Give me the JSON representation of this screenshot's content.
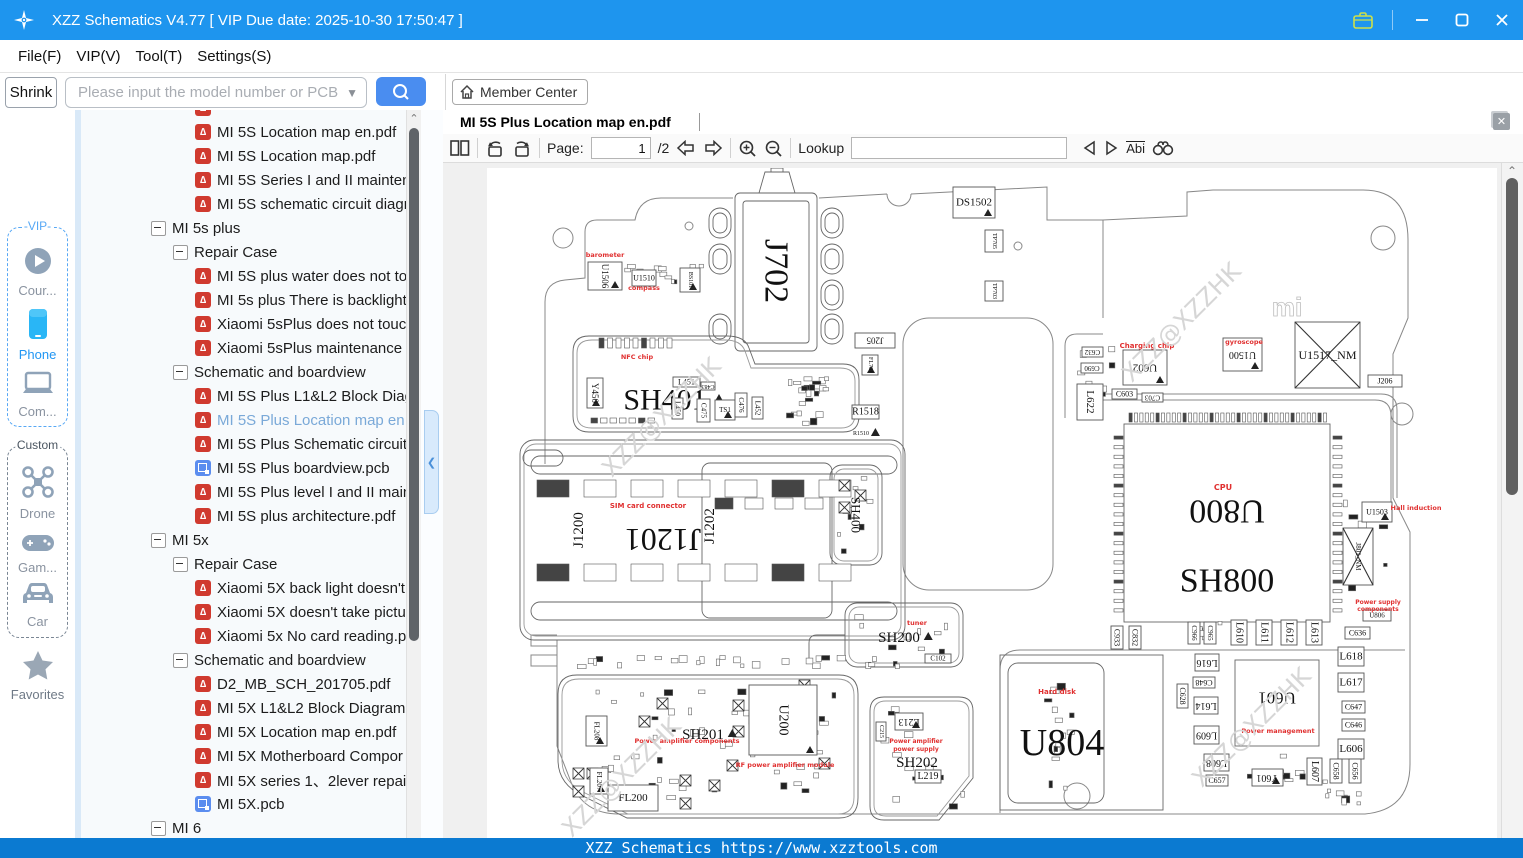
{
  "window": {
    "title": "XZZ Schematics V4.77 [ VIP Due date: 2025-10-30 17:50:47 ]",
    "menu": [
      "File(F)",
      "VIP(V)",
      "Tool(T)",
      "Settings(S)"
    ]
  },
  "toolbar": {
    "shrink": "Shrink",
    "search_placeholder": "Please input the model number or PCB",
    "member_center": "Member Center"
  },
  "sidebar": {
    "vip_label": "-VIP-",
    "custom_label": "Custom",
    "vip_items": [
      {
        "id": "course",
        "label": "Cour..."
      },
      {
        "id": "phone",
        "label": "Phone"
      },
      {
        "id": "computer",
        "label": "Com..."
      }
    ],
    "custom_items": [
      {
        "id": "drone",
        "label": "Drone"
      },
      {
        "id": "game",
        "label": "Gam..."
      },
      {
        "id": "car",
        "label": "Car"
      }
    ],
    "favorites_label": "Favorites"
  },
  "tree": {
    "items": [
      {
        "type": "pdf",
        "label": ""
      },
      {
        "type": "pdf",
        "label": "MI 5S Location map en.pdf"
      },
      {
        "type": "pdf",
        "label": "MI 5S Location map.pdf"
      },
      {
        "type": "pdf",
        "label": "MI 5S Series I and II mainten"
      },
      {
        "type": "pdf",
        "label": "MI 5S schematic circuit diagr"
      },
      {
        "type": "node",
        "depth": 0,
        "label": "MI 5s plus"
      },
      {
        "type": "node",
        "depth": 1,
        "label": "Repair Case"
      },
      {
        "type": "pdf",
        "label": "MI 5S plus water does not to"
      },
      {
        "type": "pdf",
        "label": "MI 5s plus There is backlight"
      },
      {
        "type": "pdf",
        "label": "Xiaomi 5sPlus does not touc"
      },
      {
        "type": "pdf",
        "label": "Xiaomi 5sPlus maintenance v"
      },
      {
        "type": "node",
        "depth": 1,
        "label": "Schematic and boardview"
      },
      {
        "type": "pdf",
        "label": "MI 5S Plus L1&L2 Block Diag"
      },
      {
        "type": "pdf",
        "label": "MI 5S Plus Location map en.",
        "selected": true
      },
      {
        "type": "pdf",
        "label": "MI 5S Plus Schematic circuit"
      },
      {
        "type": "pcb",
        "label": "MI 5S Plus boardview.pcb"
      },
      {
        "type": "pdf",
        "label": "MI 5S Plus level I and II main"
      },
      {
        "type": "pdf",
        "label": "MI 5S plus architecture.pdf"
      },
      {
        "type": "node",
        "depth": 0,
        "label": "MI 5x"
      },
      {
        "type": "node",
        "depth": 1,
        "label": "Repair Case"
      },
      {
        "type": "pdf",
        "label": "Xiaomi 5X back light doesn't"
      },
      {
        "type": "pdf",
        "label": "Xiaomi 5X doesn't take pictu"
      },
      {
        "type": "pdf",
        "label": "Xiaomi 5x No card reading.p"
      },
      {
        "type": "node",
        "depth": 1,
        "label": "Schematic and boardview"
      },
      {
        "type": "pdf",
        "label": "D2_MB_SCH_201705.pdf"
      },
      {
        "type": "pdf",
        "label": "MI 5X L1&L2 Block Diagram"
      },
      {
        "type": "pdf",
        "label": "MI 5X Location map en.pdf"
      },
      {
        "type": "pdf",
        "label": "MI 5X Motherboard Compor"
      },
      {
        "type": "pdf",
        "label": "MI 5X series 1、2lever repair"
      },
      {
        "type": "pcb",
        "label": "MI 5X.pcb"
      },
      {
        "type": "node",
        "depth": 0,
        "label": "MI 6"
      }
    ]
  },
  "viewer": {
    "tab": "MI 5S Plus Location map en.pdf",
    "page_label": "Page:",
    "page_value": "1",
    "page_total": "/2",
    "lookup_label": "Lookup",
    "abi_label": "Abi"
  },
  "statusbar": {
    "text": "XZZ Schematics https://www.xzztools.com"
  },
  "colors": {
    "titlebar": "#1e95ee",
    "accent_blue": "#4a8df0",
    "status_blue": "#0b7ad1",
    "pdf_red": "#d03a2f",
    "pcb_blue": "#5b8def",
    "selected_text": "#7aa9d8",
    "schem_red": "#e03030"
  },
  "schematic": {
    "watermark_text": "XZZ@XZZHK",
    "watermarks": [
      [
        180,
        255
      ],
      [
        700,
        160
      ],
      [
        770,
        565
      ],
      [
        140,
        615
      ]
    ],
    "mi_logo": "mi",
    "red_labels": [
      [
        "barometer",
        118,
        89,
        6.5
      ],
      [
        "compass",
        157,
        122,
        6.5
      ],
      [
        "NFC chip",
        150,
        191,
        6.5
      ],
      [
        "SIM card connector",
        161,
        340,
        7
      ],
      [
        "tuner",
        430,
        457,
        6.5
      ],
      [
        "Charging chip",
        660,
        180,
        7
      ],
      [
        "gyroscope",
        757,
        176,
        6.5
      ],
      [
        "CPU",
        736,
        322,
        8
      ],
      [
        "Hall induction",
        929,
        342,
        6.5
      ],
      [
        "Power supply",
        891,
        436,
        6
      ],
      [
        "components",
        891,
        443,
        6
      ],
      [
        "Hard disk",
        570,
        526,
        7
      ],
      [
        "Power management",
        791,
        565,
        6.5
      ],
      [
        "Power amplifier components",
        200,
        575,
        6.5
      ],
      [
        "RF power amplifier module",
        298,
        599,
        6.5
      ],
      [
        "Power amplifier",
        429,
        575,
        6
      ],
      [
        "power supply",
        429,
        583,
        6
      ]
    ],
    "components": [
      [
        "box",
        "DS1502",
        466,
        19,
        42,
        31,
        0,
        11,
        1
      ],
      [
        "lbl",
        "J702",
        289,
        103,
        0,
        0,
        90,
        34,
        0
      ],
      [
        "box",
        "TP705",
        498,
        62,
        18,
        22,
        90,
        6,
        0
      ],
      [
        "box",
        "TP703",
        498,
        113,
        18,
        20,
        90,
        6,
        0
      ],
      [
        "box",
        "U1506",
        101,
        94,
        34,
        28,
        90,
        9,
        1
      ],
      [
        "box",
        "U1510",
        145,
        102,
        24,
        16,
        0,
        8,
        0
      ],
      [
        "box",
        "BS101",
        193,
        100,
        20,
        24,
        90,
        6,
        1
      ],
      [
        "lbl",
        "SH401",
        178,
        232,
        0,
        0,
        0,
        30,
        1
      ],
      [
        "box",
        "Y450",
        100,
        210,
        16,
        30,
        90,
        9,
        1
      ],
      [
        "box",
        "L451",
        186,
        209,
        27,
        10,
        0,
        8,
        0
      ],
      [
        "box",
        "C483",
        214,
        214,
        14,
        8,
        180,
        6,
        0
      ],
      [
        "box",
        "L450",
        185,
        230,
        11,
        21,
        90,
        7,
        0
      ],
      [
        "box",
        "C475",
        210,
        231,
        13,
        23,
        90,
        7,
        0
      ],
      [
        "box",
        "TS1",
        228,
        232,
        20,
        20,
        0,
        7,
        1
      ],
      [
        "box",
        "C476",
        248,
        225,
        12,
        24,
        90,
        7,
        0
      ],
      [
        "box",
        "L452",
        265,
        229,
        11,
        22,
        90,
        7,
        0
      ],
      [
        "box",
        "J205",
        368,
        165,
        40,
        15,
        180,
        9,
        0
      ],
      [
        "box",
        "FL701",
        375,
        187,
        16,
        20,
        90,
        6,
        1
      ],
      [
        "box",
        "R1518",
        365,
        237,
        27,
        14,
        0,
        10,
        0
      ],
      [
        "lbl",
        "R1510",
        374,
        266,
        0,
        0,
        0,
        6,
        1
      ],
      [
        "lbl",
        "J1200",
        92,
        362,
        0,
        0,
        -90,
        15,
        0
      ],
      [
        "lbl",
        "J1201",
        176,
        372,
        0,
        0,
        180,
        32,
        0
      ],
      [
        "lbl",
        "J1202",
        223,
        358,
        0,
        0,
        -90,
        15,
        0
      ],
      [
        "lbl",
        "SH400",
        369,
        347,
        0,
        0,
        90,
        13,
        0
      ],
      [
        "lbl",
        "SH200",
        412,
        470,
        0,
        0,
        0,
        15,
        1
      ],
      [
        "box",
        "C102",
        438,
        486,
        26,
        9,
        0,
        7,
        0
      ],
      [
        "box",
        "L213",
        408,
        545,
        28,
        17,
        180,
        10,
        1
      ],
      [
        "lbl",
        "SH202",
        430,
        595,
        0,
        0,
        0,
        15,
        0
      ],
      [
        "box",
        "L219",
        428,
        602,
        26,
        13,
        0,
        10,
        0
      ],
      [
        "box",
        "C215",
        389,
        554,
        10,
        19,
        90,
        6,
        0
      ],
      [
        "lbl",
        "SH201",
        216,
        567,
        0,
        0,
        0,
        15,
        1
      ],
      [
        "box",
        "U200",
        262,
        517,
        68,
        70,
        90,
        14,
        1
      ],
      [
        "box",
        "FL200",
        121,
        617,
        50,
        26,
        0,
        11,
        0
      ],
      [
        "box",
        "FL208",
        99,
        548,
        21,
        30,
        90,
        7,
        1
      ],
      [
        "box",
        "FL207",
        103,
        600,
        18,
        26,
        90,
        7,
        1
      ],
      [
        "lbl",
        "U800",
        740,
        343,
        0,
        0,
        180,
        34,
        0
      ],
      [
        "lbl",
        "SH800",
        740,
        413,
        0,
        0,
        0,
        34,
        0
      ],
      [
        "xbox",
        "U1517_NM",
        808,
        154,
        65,
        66,
        0,
        12,
        0
      ],
      [
        "box",
        "U1500",
        736,
        170,
        39,
        33,
        180,
        10,
        1
      ],
      [
        "box",
        "U602",
        636,
        182,
        44,
        35,
        180,
        11,
        1
      ],
      [
        "box",
        "C632",
        595,
        179,
        21,
        10,
        180,
        7,
        0
      ],
      [
        "box",
        "C690",
        594,
        195,
        22,
        10,
        180,
        7,
        0
      ],
      [
        "box",
        "L622",
        590,
        216,
        26,
        36,
        90,
        11,
        0
      ],
      [
        "box",
        "C603",
        625,
        221,
        25,
        10,
        0,
        8,
        0
      ],
      [
        "box",
        "C703",
        655,
        225,
        21,
        9,
        180,
        7,
        0
      ],
      [
        "box",
        "J206",
        881,
        207,
        34,
        12,
        0,
        8,
        0
      ],
      [
        "box",
        "U1503",
        875,
        334,
        30,
        20,
        0,
        8,
        1
      ],
      [
        "xbox",
        "J801_NM",
        856,
        360,
        30,
        57,
        90,
        7,
        0
      ],
      [
        "box",
        "U806",
        876,
        442,
        28,
        11,
        0,
        7,
        0
      ],
      [
        "box",
        "L610",
        744,
        452,
        16,
        25,
        90,
        10,
        0
      ],
      [
        "box",
        "L611",
        769,
        452,
        16,
        25,
        90,
        10,
        0
      ],
      [
        "box",
        "L612",
        794,
        452,
        16,
        25,
        90,
        10,
        0
      ],
      [
        "box",
        "L613",
        819,
        452,
        16,
        25,
        90,
        10,
        0
      ],
      [
        "box",
        "C966",
        701,
        454,
        12,
        22,
        90,
        7,
        0
      ],
      [
        "box",
        "C965",
        717,
        454,
        12,
        22,
        90,
        7,
        0
      ],
      [
        "box",
        "C636",
        858,
        459,
        25,
        12,
        0,
        8,
        0
      ],
      [
        "box",
        "L618",
        851,
        479,
        26,
        19,
        0,
        11,
        0
      ],
      [
        "box",
        "L617",
        851,
        505,
        26,
        19,
        0,
        11,
        0
      ],
      [
        "box",
        "C647",
        855,
        533,
        23,
        12,
        0,
        8,
        0
      ],
      [
        "box",
        "C646",
        855,
        551,
        23,
        12,
        0,
        8,
        0
      ],
      [
        "box",
        "L606",
        851,
        571,
        26,
        20,
        0,
        11,
        0
      ],
      [
        "box",
        "L616",
        708,
        486,
        24,
        17,
        180,
        10,
        0
      ],
      [
        "box",
        "C648",
        706,
        509,
        22,
        11,
        180,
        8,
        0
      ],
      [
        "box",
        "C628",
        690,
        516,
        11,
        24,
        90,
        8,
        0
      ],
      [
        "box",
        "L614",
        707,
        529,
        24,
        17,
        180,
        10,
        0
      ],
      [
        "box",
        "L609",
        707,
        558,
        25,
        18,
        180,
        10,
        0
      ],
      [
        "box",
        "L608",
        717,
        586,
        25,
        17,
        180,
        10,
        0
      ],
      [
        "box",
        "C657",
        719,
        607,
        22,
        11,
        0,
        8,
        0
      ],
      [
        "box",
        "C933",
        624,
        458,
        12,
        23,
        90,
        8,
        0
      ],
      [
        "box",
        "C832",
        642,
        458,
        12,
        23,
        90,
        8,
        0
      ],
      [
        "lbl",
        "U601",
        790,
        530,
        0,
        0,
        180,
        17,
        0
      ],
      [
        "box",
        "Y601",
        765,
        601,
        31,
        17,
        180,
        10,
        1
      ],
      [
        "box",
        "L607",
        820,
        590,
        15,
        27,
        90,
        10,
        0
      ],
      [
        "box",
        "C658",
        843,
        591,
        12,
        24,
        90,
        8,
        0
      ],
      [
        "box",
        "C656",
        862,
        591,
        12,
        24,
        90,
        8,
        0
      ],
      [
        "lbl",
        "U804",
        575,
        575,
        0,
        0,
        0,
        38,
        0
      ]
    ],
    "clusters": [
      [
        292,
        206,
        50,
        52,
        24,
        7
      ],
      [
        137,
        96,
        50,
        30,
        8,
        11
      ],
      [
        590,
        176,
        42,
        70,
        10,
        13
      ],
      [
        78,
        487,
        335,
        16,
        26,
        17
      ],
      [
        100,
        518,
        250,
        115,
        48,
        19
      ],
      [
        392,
        534,
        86,
        108,
        12,
        23
      ],
      [
        742,
        585,
        105,
        32,
        10,
        29
      ],
      [
        350,
        306,
        40,
        82,
        8,
        31
      ],
      [
        366,
        442,
        104,
        52,
        10,
        37
      ],
      [
        556,
        494,
        34,
        136,
        14,
        41
      ],
      [
        856,
        332,
        46,
        92,
        10,
        43
      ],
      [
        698,
        452,
        40,
        24,
        6,
        47
      ],
      [
        183,
        96,
        36,
        28,
        6,
        53
      ],
      [
        836,
        618,
        60,
        20,
        8,
        59
      ]
    ],
    "pin_rows": [
      [
        642,
        245,
        37,
        5.4,
        0,
        3.2,
        9
      ],
      [
        627,
        268,
        19,
        0,
        9.6,
        9,
        3.2
      ],
      [
        846,
        268,
        19,
        0,
        9.6,
        9,
        3.2
      ],
      [
        112,
        170,
        9,
        8.5,
        0,
        5,
        10
      ],
      [
        104,
        250,
        7,
        9.5,
        0,
        6.5,
        5
      ],
      [
        50,
        312,
        7,
        47,
        0,
        32,
        17
      ],
      [
        50,
        396,
        7,
        47,
        0,
        32,
        17
      ],
      [
        228,
        330,
        4,
        30,
        0,
        18,
        11
      ]
    ],
    "crossed_small": [
      [
        86,
        600
      ],
      [
        100,
        600
      ],
      [
        86,
        618
      ],
      [
        193,
        607
      ],
      [
        193,
        630
      ],
      [
        352,
        312
      ],
      [
        352,
        334
      ],
      [
        368,
        322
      ],
      [
        262,
        545
      ],
      [
        246,
        532
      ],
      [
        299,
        536
      ],
      [
        290,
        558
      ],
      [
        246,
        558
      ],
      [
        312,
        512
      ],
      [
        332,
        590
      ],
      [
        222,
        612
      ],
      [
        240,
        592
      ],
      [
        170,
        530
      ],
      [
        152,
        548
      ]
    ]
  }
}
